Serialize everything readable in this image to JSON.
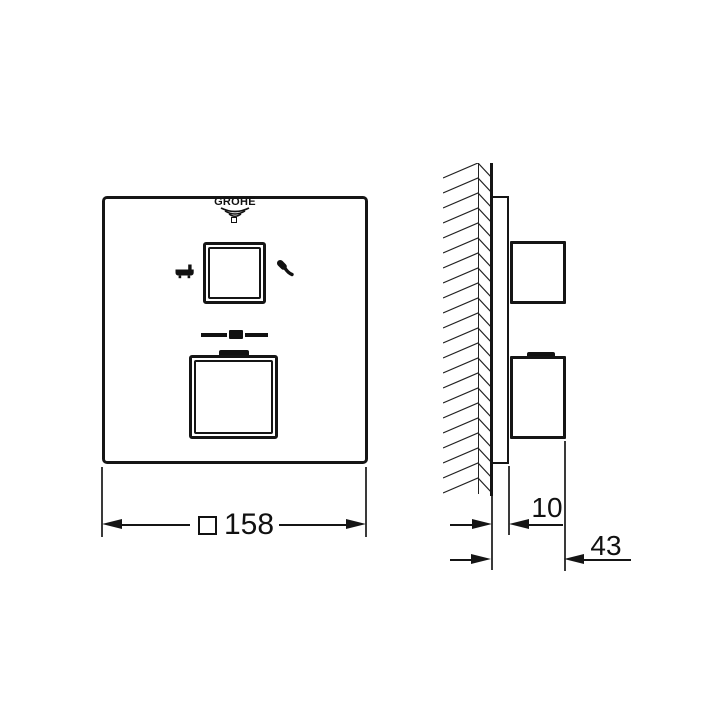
{
  "colors": {
    "line": "#151515",
    "background": "#ffffff"
  },
  "front_view": {
    "brand_logo": {
      "text": "GROHE",
      "waves_icon": "water-waves-icon",
      "marker_icon": "small-square-marker"
    },
    "upper_knob": {
      "name": "diverter-knob",
      "left_icon": "bathtub-icon",
      "right_icon": "hand-shower-icon"
    },
    "temperature_marker_icon": "temperature-scale-marker",
    "lower_knob": {
      "name": "thermostat-knob",
      "grip_icon": "grip-tab"
    },
    "width_dimension": {
      "label": "□ 158",
      "symbol": "□",
      "value": "158"
    }
  },
  "side_view": {
    "wall_pattern_icon": "hatched-wall",
    "plate_depth_dimension": {
      "value": "10"
    },
    "total_depth_dimension": {
      "value": "43"
    }
  }
}
